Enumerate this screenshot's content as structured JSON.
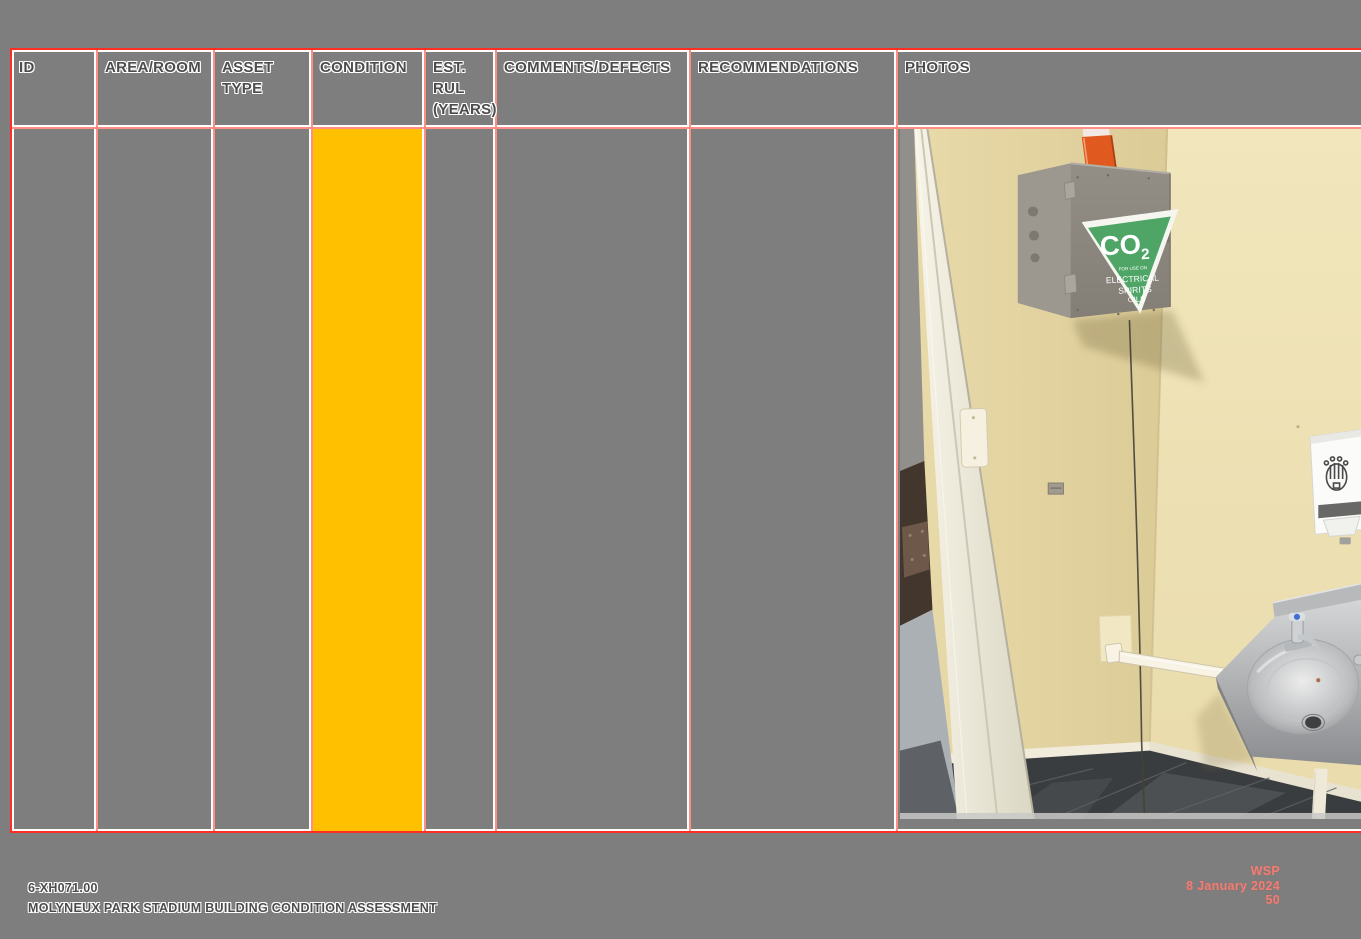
{
  "page": {
    "background_color": "#7e7e7e"
  },
  "table": {
    "columns": [
      {
        "label": "ID"
      },
      {
        "label": "AREA/ROOM"
      },
      {
        "label": "ASSET TYPE"
      },
      {
        "label": "CONDITION"
      },
      {
        "label": "EST. RUL (YEARS)"
      },
      {
        "label": "COMMENTS/DEFECTS"
      },
      {
        "label": "RECOMMENDATIONS"
      },
      {
        "label": "PHOTOS"
      }
    ],
    "row": {
      "id": "",
      "area_room": "",
      "asset_type": "",
      "condition": "",
      "condition_color": "#FFC000",
      "est_rul_years": "",
      "comments_defects": "",
      "recommendations": ""
    },
    "border_colors": {
      "outer": "#ff2d22",
      "grid": "#ff8e85",
      "grid_highlight": "#ffffff"
    }
  },
  "photo": {
    "co2_sign": {
      "main": "CO",
      "sub": "2",
      "line1": "FOR USE ON",
      "line2": "ELECTRICAL",
      "line3": "SPIRITS",
      "line4": "OILS",
      "green": "#4ea566"
    }
  },
  "footer": {
    "left": {
      "line1": "6-XH071.00",
      "line2": "MOLYNEUX PARK STADIUM BUILDING CONDITION ASSESSMENT"
    },
    "right": {
      "line1": "WSP",
      "line2": "8 January 2024",
      "line3": "50",
      "color": "#ef7f75"
    }
  }
}
